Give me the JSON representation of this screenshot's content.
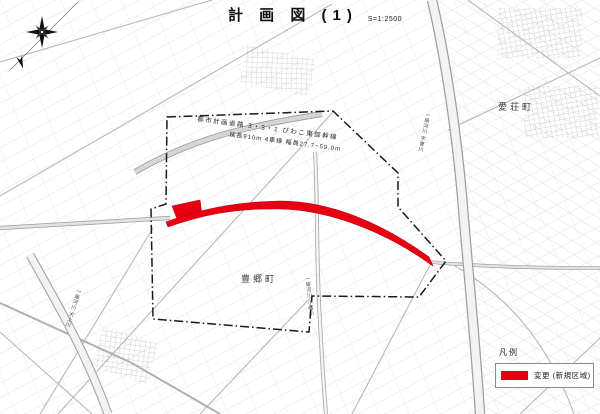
{
  "colors": {
    "change_red": "#e60012",
    "boundary": "#1a1a1a",
    "road_gray": "#9a9a9a",
    "parcel_gray": "#d8d8d8"
  },
  "title": {
    "text": "計 画 図 (1)",
    "scale": "S=1:2500"
  },
  "compass": {
    "icon": "compass-rose",
    "north": "N"
  },
  "annotations": {
    "road_line1": "都市計画道路 3・3・1 びわこ東部幹線",
    "road_line2": "延長910m 4車線 幅員27.7~59.0m"
  },
  "places": {
    "aisho": "愛荘町",
    "toyosato": "豊郷町"
  },
  "rivers": {
    "uso": "一級河川 宇曽川",
    "obata": "一級河川 小幡川",
    "inukami": "一級河川 犬上川"
  },
  "legend": {
    "heading": "凡例",
    "items": [
      {
        "label": "変更 (新規区域)",
        "color": "#e60012"
      }
    ]
  }
}
